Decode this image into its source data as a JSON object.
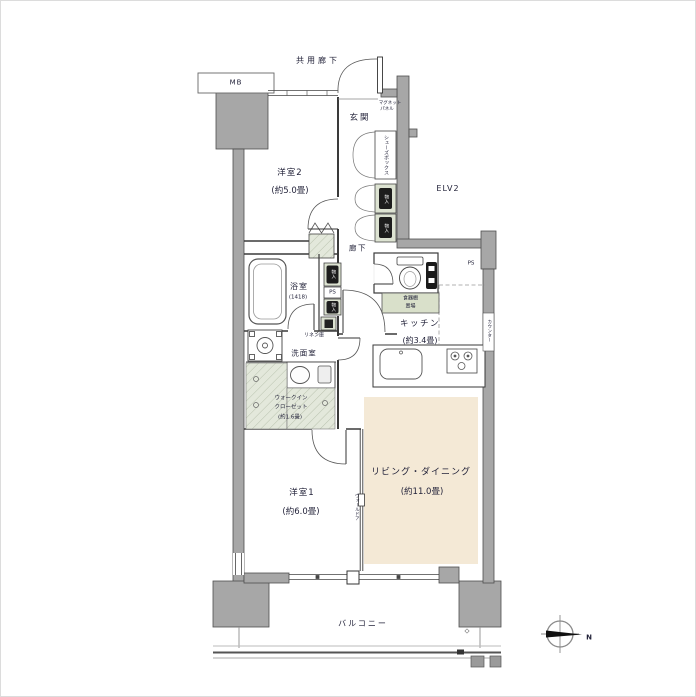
{
  "plan_title": "2LDK apartment floor plan",
  "rooms": {
    "bedroom2": {
      "name": "洋室2",
      "size": "(約5.0畳)"
    },
    "bedroom1": {
      "name": "洋室1",
      "size": "(約6.0畳)"
    },
    "living_dining": {
      "name": "リビング・ダイニング",
      "size": "(約11.0畳)"
    },
    "kitchen": {
      "name": "キッチン",
      "size": "(約3.4畳)"
    },
    "bathroom": {
      "name": "浴室",
      "size": "(1418)"
    },
    "washroom": {
      "name": "洗面室"
    },
    "wic": {
      "line1": "ウォークイン",
      "line2": "クローゼット",
      "size": "(約1.6畳)"
    },
    "entrance": {
      "name": "玄関"
    },
    "hallway": {
      "name": "廊下"
    },
    "balcony": {
      "name": "バルコニー"
    }
  },
  "annotations": {
    "common_corridor": "共用廊下",
    "meter_box": "MB",
    "elevator": "ELV2",
    "pipe_space": "PS",
    "shoe_box": "シューズボックス",
    "storage": "物入",
    "magnet_panel_line1": "マグネット",
    "magnet_panel_line2": "パネル",
    "linen_closet": "リネン庫",
    "cupboard_line1": "食器棚",
    "cupboard_line2": "置場",
    "counter": "カウンター",
    "wall_door": "ウォールドア",
    "compass_north": "N"
  },
  "colors": {
    "wall_fill": "#a7a7a7",
    "wall_stroke": "#4e4e4e",
    "living_dining_floor": "#f4e9d6",
    "closet_fill": "#e3e8db",
    "storage_green": "#dde3d2",
    "cupboard_green": "#d9e0ca",
    "text": "#23233a"
  }
}
